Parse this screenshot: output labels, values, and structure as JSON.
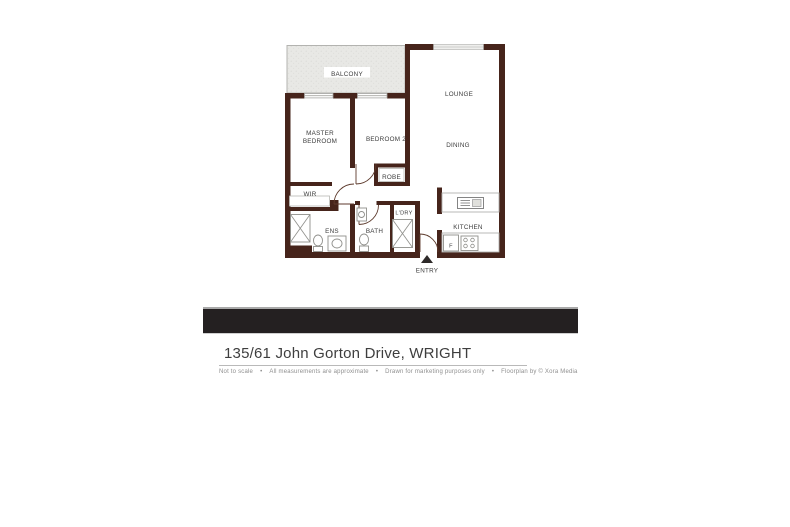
{
  "floorplan": {
    "rooms": {
      "balcony": "BALCONY",
      "lounge": "LOUNGE",
      "master_line1": "MASTER",
      "master_line2": "BEDROOM",
      "bedroom2": "BEDROOM 2",
      "dining": "DINING",
      "robe": "ROBE",
      "wir": "WIR",
      "ldry": "L'DRY",
      "ens": "ENS",
      "bath": "BATH",
      "kitchen": "KITCHEN",
      "fridge": "F",
      "entry": "ENTRY"
    },
    "colors": {
      "wall": "#46241b",
      "balcony_fill": "#e8e8e5",
      "banner": "#242021"
    }
  },
  "title": "135/61 John Gorton Drive, WRIGHT",
  "disclaimer": {
    "separator": "•",
    "items": [
      "Not to scale",
      "All measurements are approximate",
      "Drawn for marketing purposes only",
      "Floorplan by © Xora Media"
    ]
  }
}
